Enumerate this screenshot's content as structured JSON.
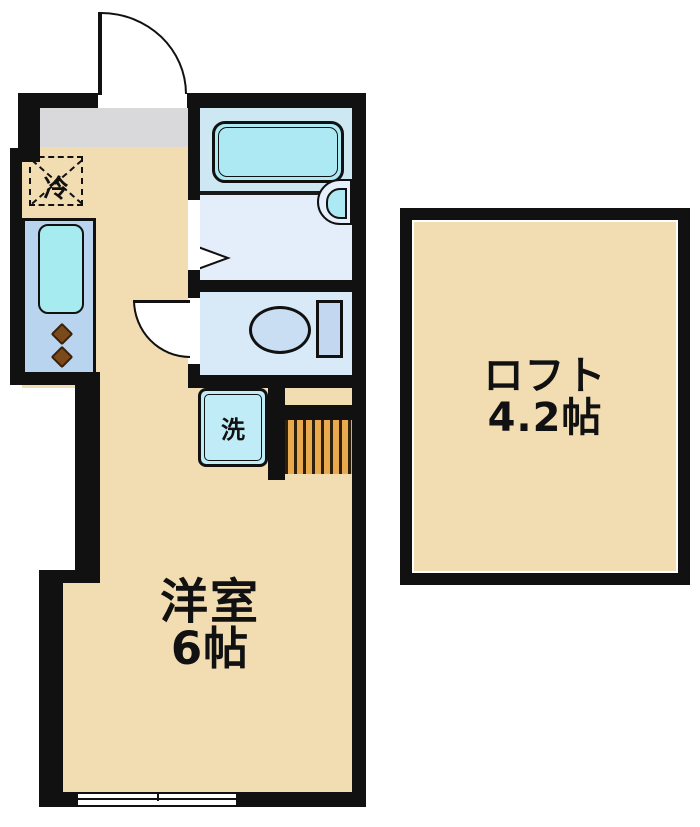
{
  "plan_type": "apartment-floor-plan",
  "rooms": {
    "main": {
      "name": "洋室",
      "size": "6帖"
    },
    "loft": {
      "name": "ロフト",
      "size": "4.2帖"
    }
  },
  "fixtures": {
    "refrigerator": "冷",
    "washing_machine": "洗"
  },
  "colors": {
    "wall": "#111111",
    "floor": "#f2dcb2",
    "entrance_floor": "#d9d9db",
    "bath_upper": "#cde7f3",
    "bath_lower": "#e3eefa",
    "bathtub": "#ace9f3",
    "toilet_floor": "#d8eaf8",
    "kitchen_panel": "#b9d4ee",
    "kitchen_sink": "#a5ebf0",
    "washer": "#bfecf6",
    "stairs": "#e9a94f",
    "burner": "#7b4a1a"
  }
}
